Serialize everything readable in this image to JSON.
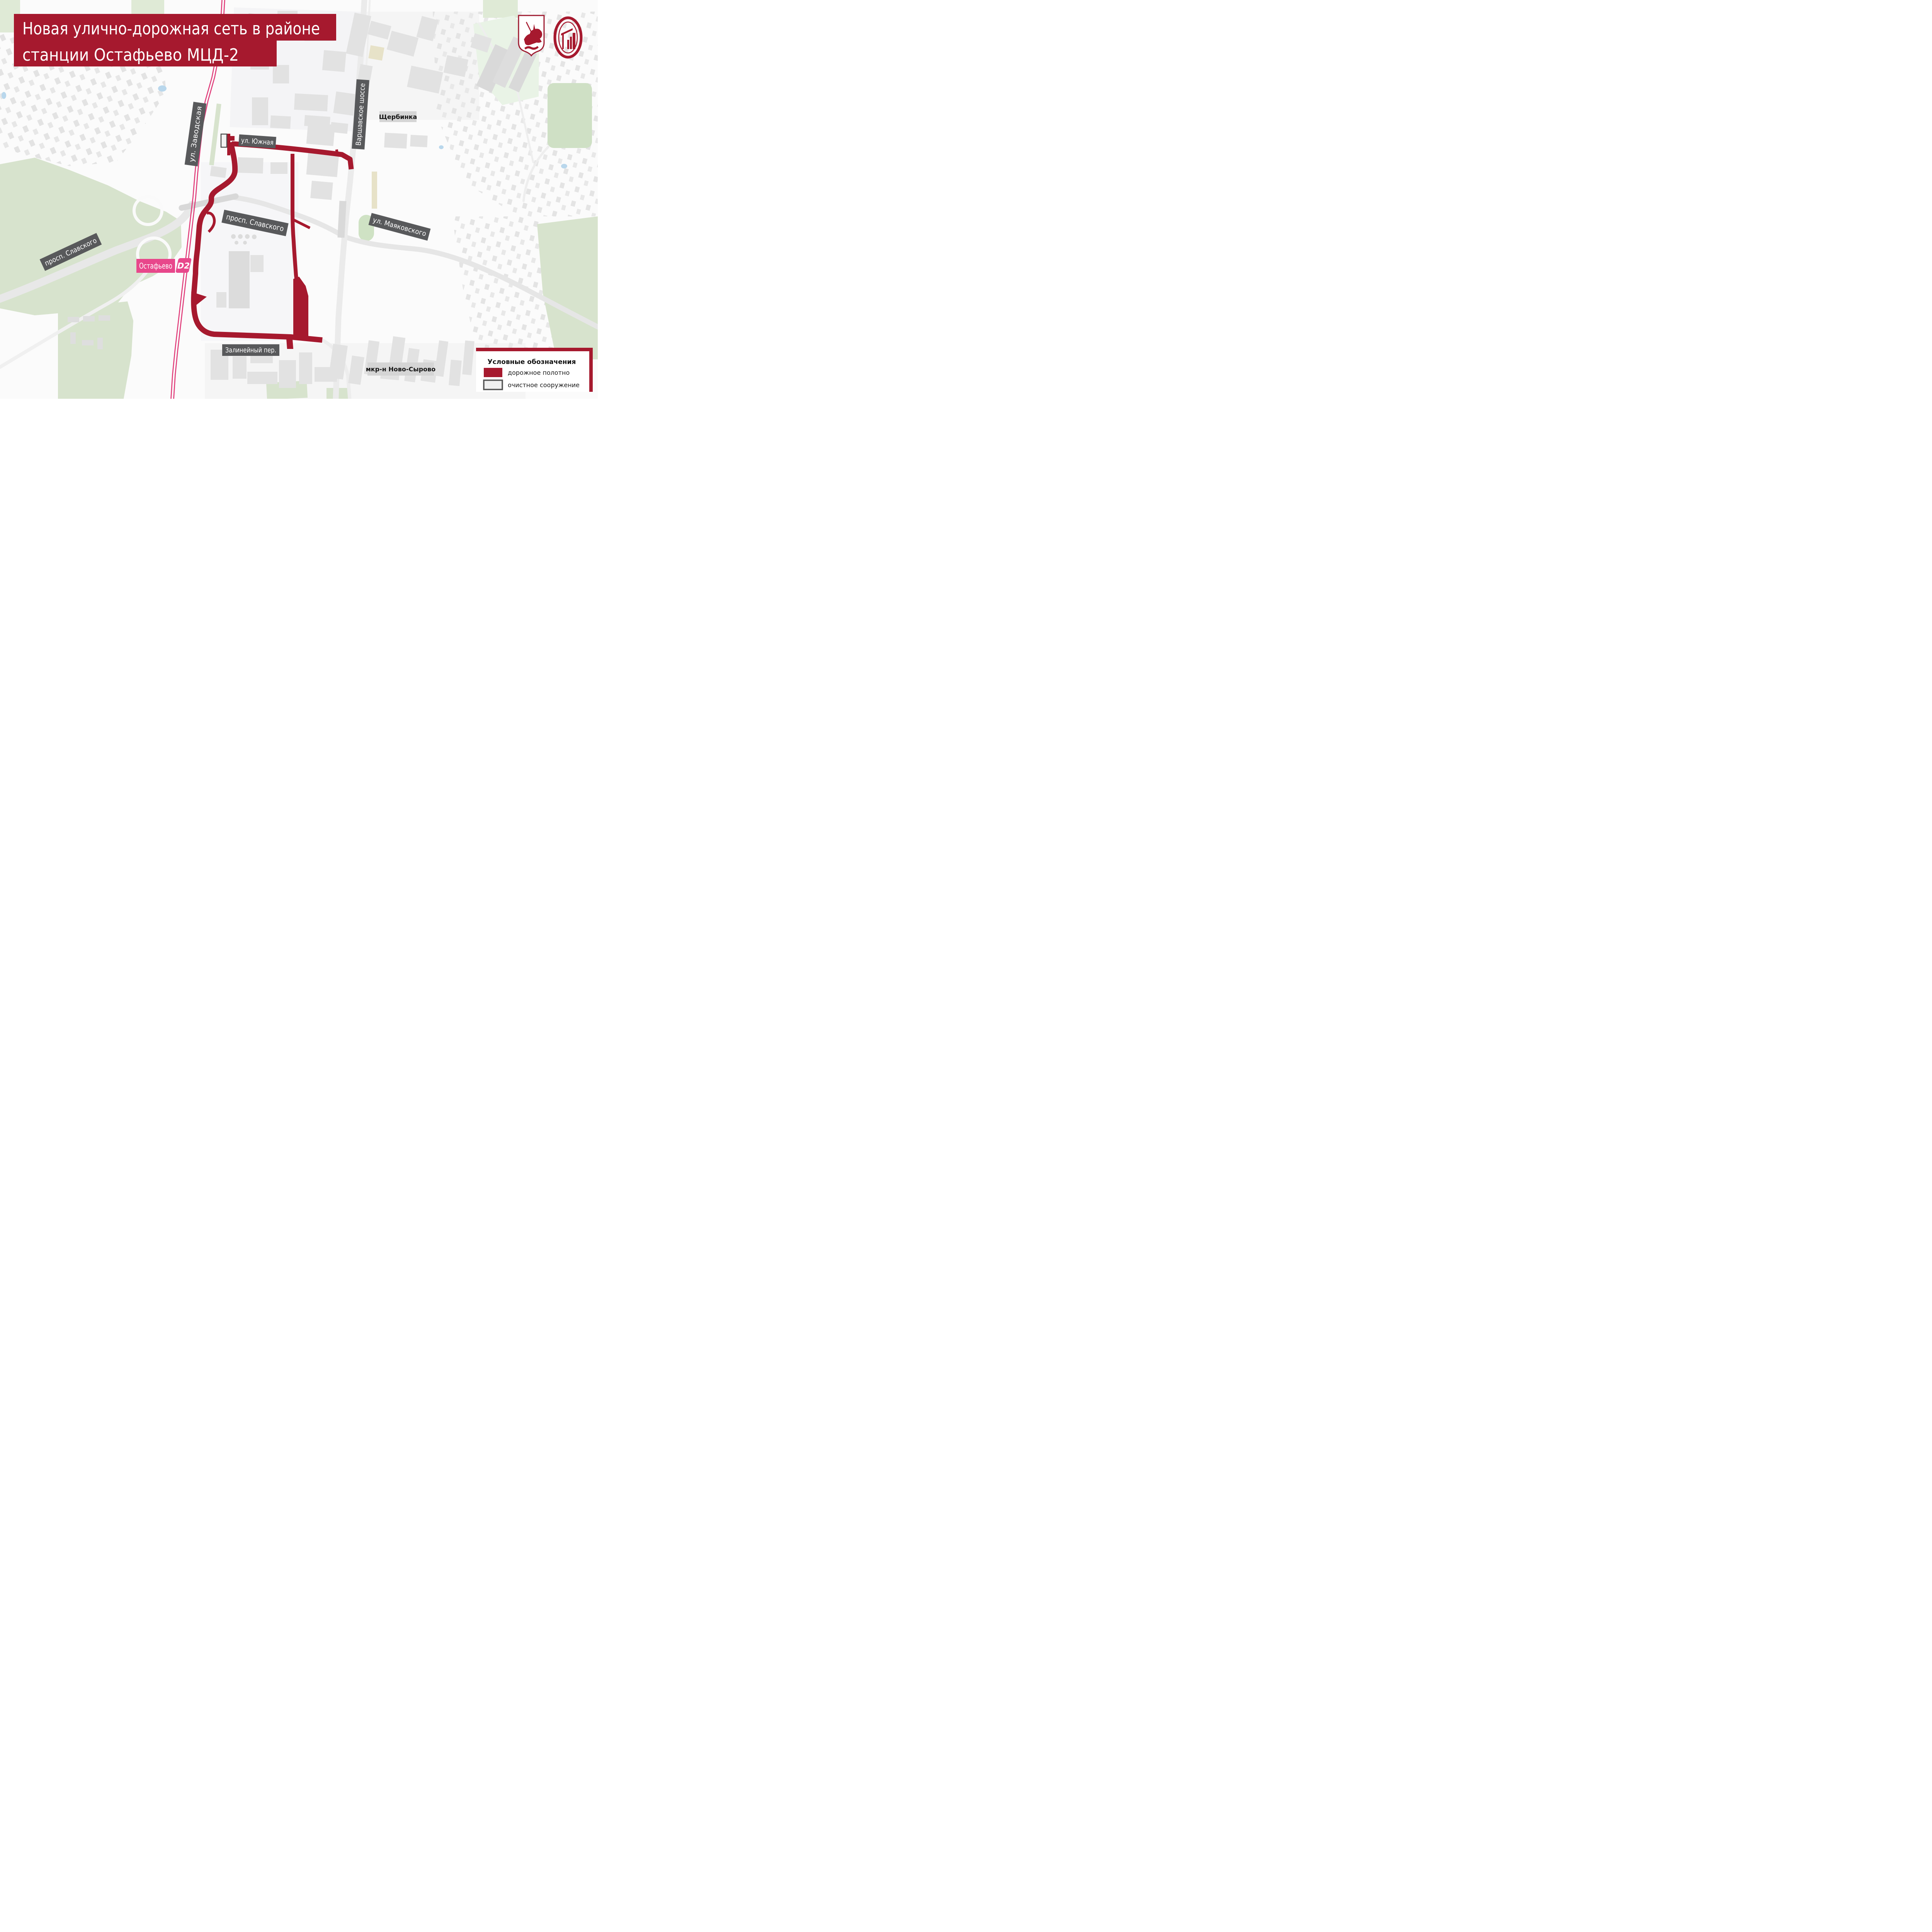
{
  "header": {
    "title_line1": "Новая улично-дорожная сеть в районе",
    "title_line2": "станции Остафьево МЦД-2"
  },
  "map": {
    "street_labels": [
      {
        "id": "zavodskaya",
        "text": "ул. Заводская"
      },
      {
        "id": "yuzhnaya",
        "text": "ул. Южная"
      },
      {
        "id": "varshavskoe",
        "text": "Варшавское шоссе"
      },
      {
        "id": "slavskogo_west",
        "text": "просп. Славского"
      },
      {
        "id": "slavskogo_east",
        "text": "просп. Славского"
      },
      {
        "id": "mayakovskogo",
        "text": "ул. Маяковского"
      },
      {
        "id": "zalineyny",
        "text": "Залинейный пер."
      }
    ],
    "area_labels": [
      {
        "id": "shcherbinka",
        "text": "Щербинка"
      },
      {
        "id": "novo_syrovo",
        "text": "мкр-н Ново-Сырово"
      }
    ],
    "station": {
      "name": "Остафьево",
      "line_badge": "D2"
    }
  },
  "legend": {
    "title": "Условные обозначения",
    "items": [
      {
        "label": "дорожное полотно"
      },
      {
        "label": "очистное сооружение"
      }
    ]
  },
  "colors": {
    "new_road": "#a6192e",
    "title_banner": "#a6192e",
    "railway_mcd2": "#e03a78",
    "station_badge": "#e8478b",
    "street_banner": "#58595b",
    "area_label_bg": "#d5d5d5",
    "legend_facility_border": "#555555"
  }
}
